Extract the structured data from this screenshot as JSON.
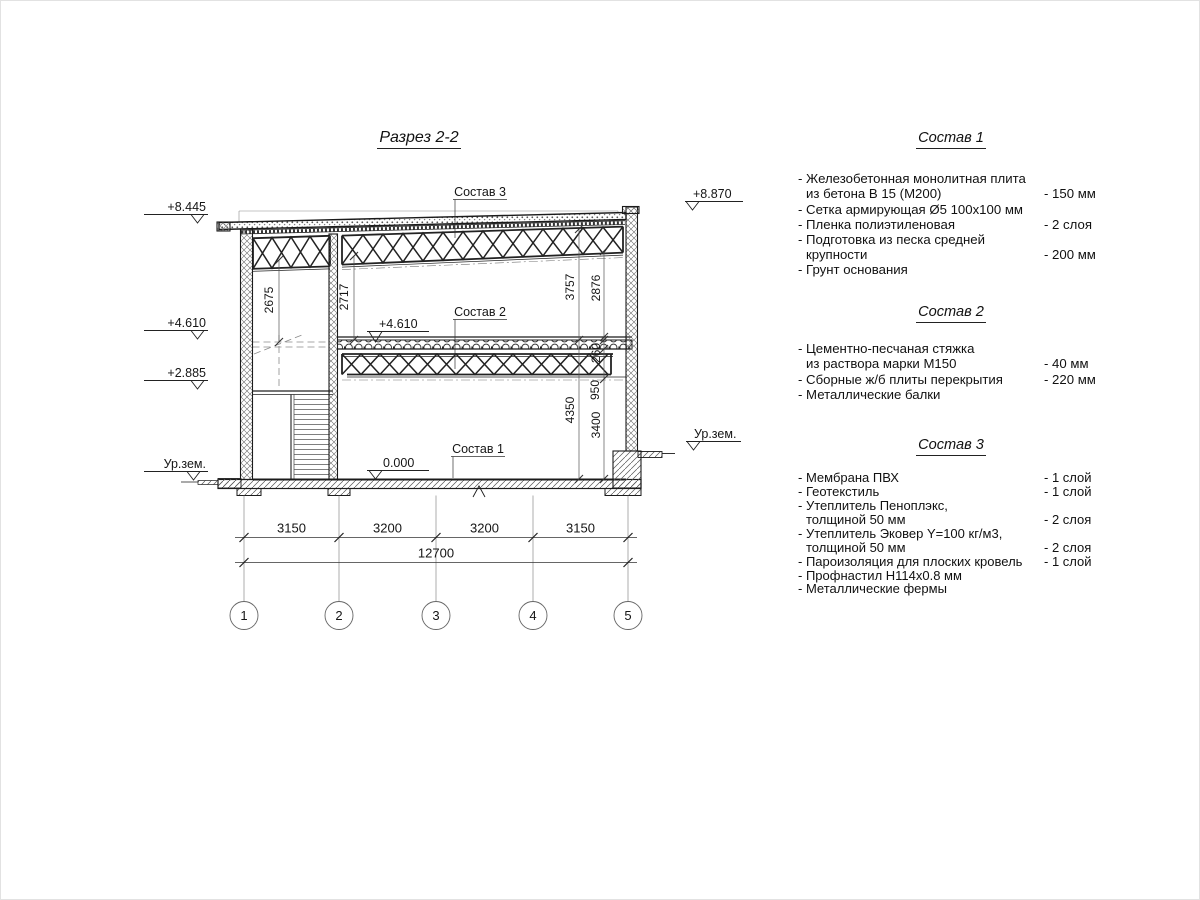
{
  "title": "Разрез 2-2",
  "section": {
    "callouts": {
      "c3": "Состав 3",
      "c2": "Состав 2",
      "c1": "Состав 1"
    },
    "marks": {
      "left": {
        "m8445": "+8.445",
        "m4610": "+4.610",
        "m2885": "+2.885",
        "ground": "Ур.зем."
      },
      "right": {
        "m8870": "+8.870",
        "ground": "Ур.зем."
      },
      "inner": {
        "m4610": "+4.610",
        "m0": "0.000"
      }
    },
    "dims": {
      "v2675": "2675",
      "v2717": "2717",
      "v3757": "3757",
      "v2876": "2876",
      "v260": "260",
      "v950": "950",
      "v4350": "4350",
      "v3400": "3400",
      "b1": "3150",
      "b2": "3200",
      "b3": "3200",
      "b4": "3150",
      "total": "12700"
    },
    "grid": {
      "g1": "1",
      "g2": "2",
      "g3": "3",
      "g4": "4",
      "g5": "5"
    }
  },
  "specs": [
    {
      "title": "Состав 1",
      "rows": [
        {
          "t": "- Железобетонная  монолитная плита",
          "v": ""
        },
        {
          "t": "из бетона В 15 (М200)",
          "v": "- 150 мм"
        },
        {
          "t": "- Сетка армирующая Ø5 100х100 мм",
          "v": ""
        },
        {
          "t": "- Пленка полиэтиленовая",
          "v": "-  2 слоя"
        },
        {
          "t": "- Подготовка из песка средней",
          "v": ""
        },
        {
          "t": "крупности",
          "v": "- 200 мм"
        },
        {
          "t": "- Грунт основания",
          "v": ""
        }
      ]
    },
    {
      "title": "Состав 2",
      "rows": [
        {
          "t": "- Цементно-песчаная стяжка",
          "v": ""
        },
        {
          "t": "из раствора марки М150",
          "v": "- 40 мм"
        },
        {
          "t": "- Сборные ж/б плиты перекрытия",
          "v": "- 220 мм"
        },
        {
          "t": "- Металлические балки",
          "v": ""
        }
      ]
    },
    {
      "title": "Состав 3",
      "rows": [
        {
          "t": "- Мембрана ПВХ",
          "v": "- 1 слой"
        },
        {
          "t": "- Геотекстиль",
          "v": "- 1 слой"
        },
        {
          "t": "- Утеплитель Пеноплэкс,",
          "v": ""
        },
        {
          "t": "толщиной 50 мм",
          "v": "- 2 слоя"
        },
        {
          "t": "- Утеплитель Эковер Y=100 кг/м3,",
          "v": ""
        },
        {
          "t": "толщиной 50 мм",
          "v": "- 2 слоя"
        },
        {
          "t": "- Пароизоляция для плоских кровель",
          "v": "- 1 слой"
        },
        {
          "t": "- Профнастил Н114х0.8 мм",
          "v": ""
        },
        {
          "t": "- Металлические фермы",
          "v": ""
        }
      ]
    }
  ]
}
